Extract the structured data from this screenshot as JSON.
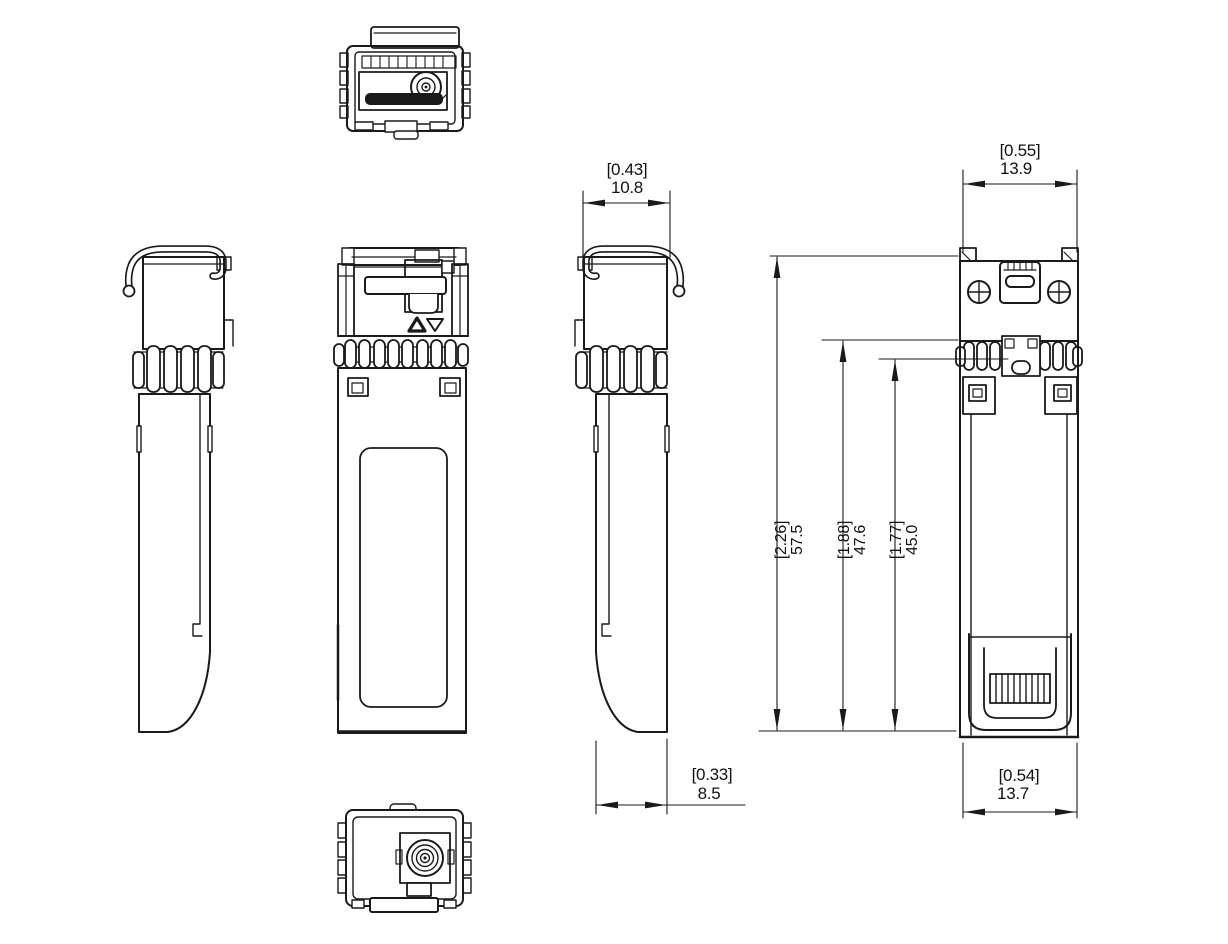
{
  "colors": {
    "background": "#ffffff",
    "line": "#1a1a1a"
  },
  "dims": {
    "side_top": {
      "in": "[0.43]",
      "mm": "10.8"
    },
    "face_top": {
      "in": "[0.55]",
      "mm": "13.9"
    },
    "overall_len": {
      "in": "[2.26]",
      "mm": "57.5"
    },
    "body_len": {
      "in": "[1.88]",
      "mm": "47.6"
    },
    "inner_len": {
      "in": "[1.77]",
      "mm": "45.0"
    },
    "side_bottom": {
      "in": "[0.33]",
      "mm": "8.5"
    },
    "face_bottom": {
      "in": "[0.54]",
      "mm": "13.7"
    }
  }
}
